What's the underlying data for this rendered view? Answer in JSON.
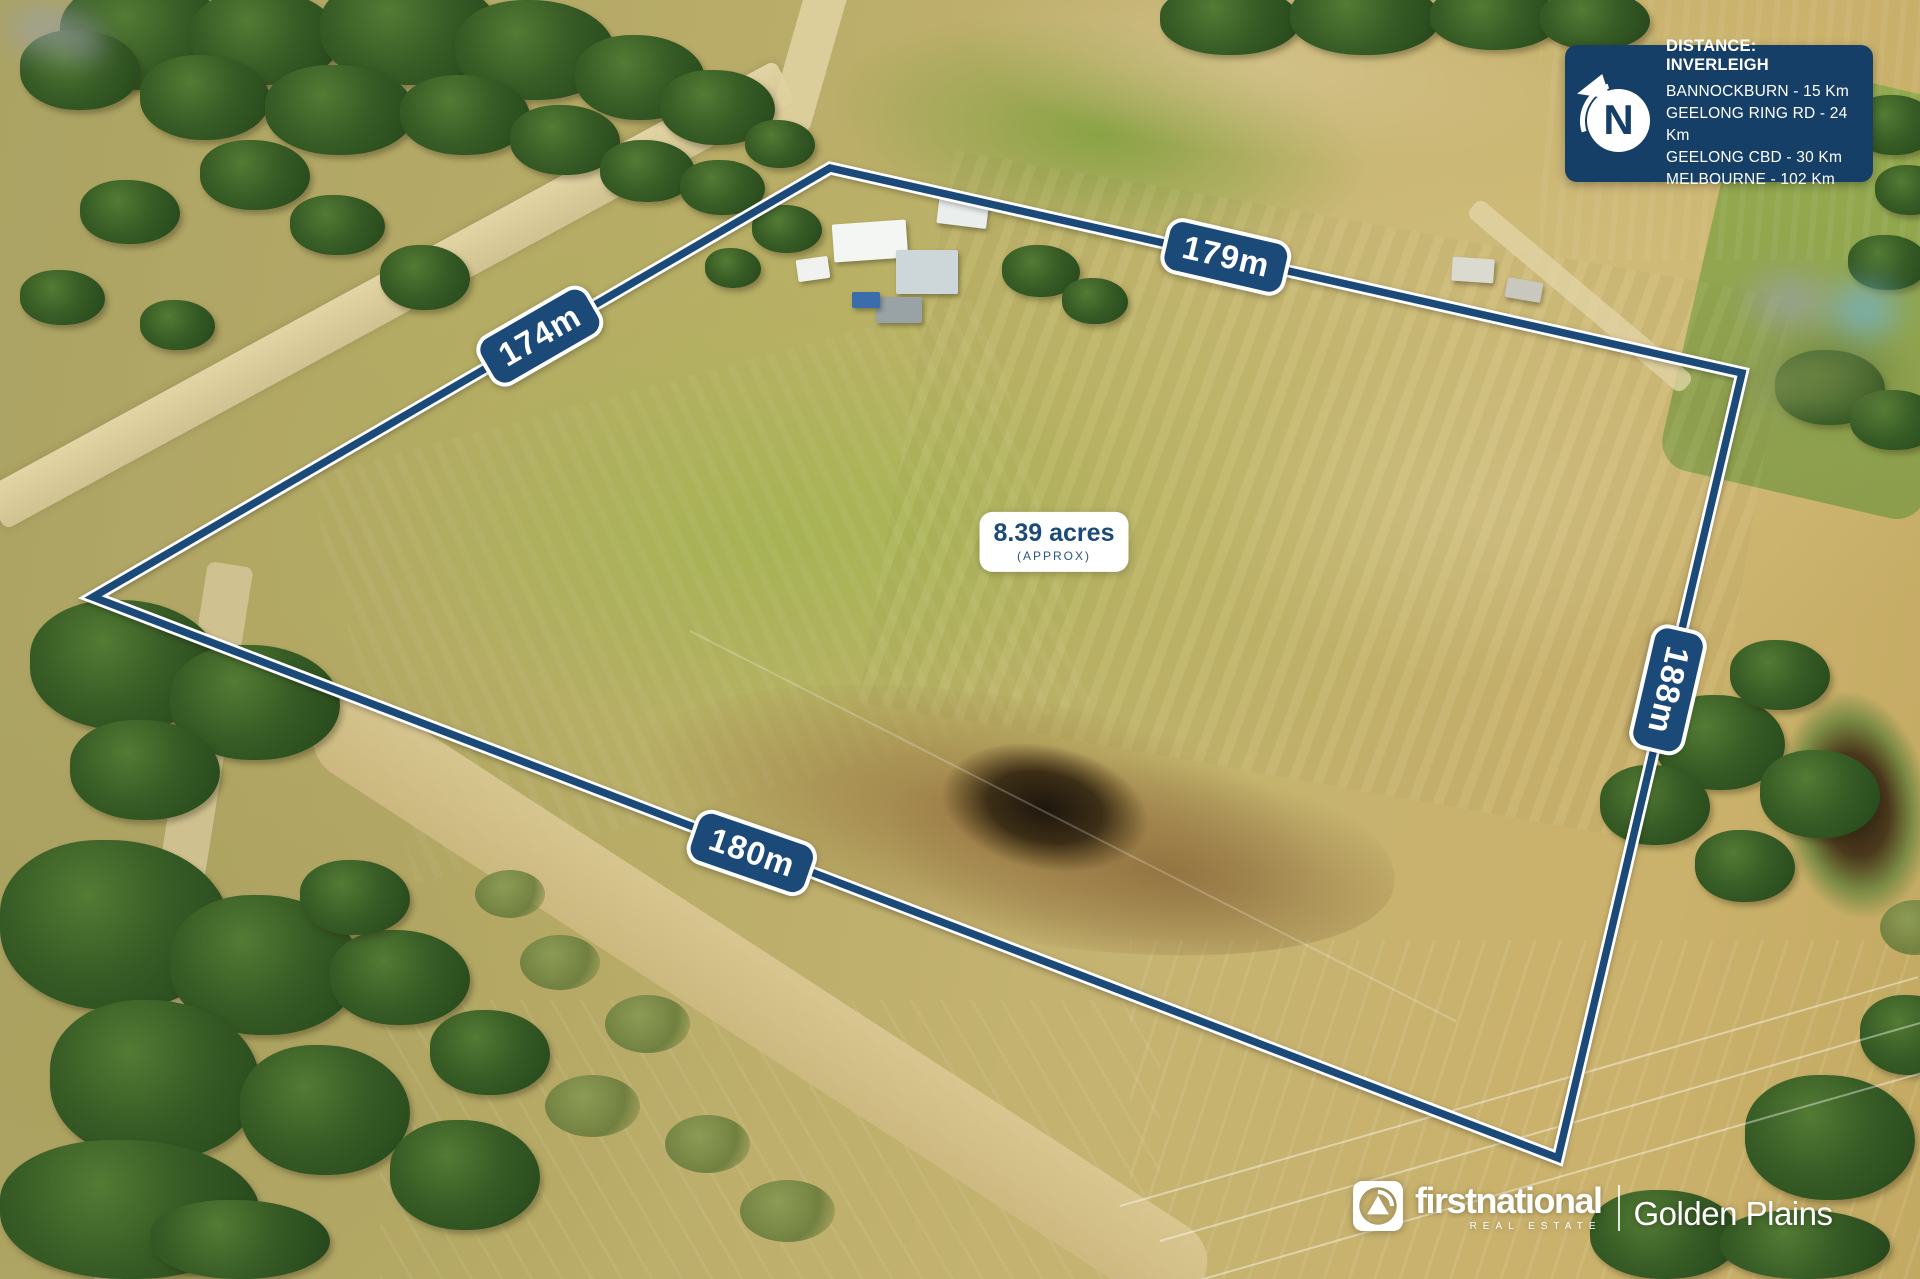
{
  "distance_panel": {
    "title": "DISTANCE: INVERLEIGH",
    "items": [
      "BANNOCKBURN - 15 Km",
      "GEELONG RING RD - 24 Km",
      "GEELONG CBD - 30 Km",
      "MELBOURNE - 102 Km"
    ],
    "compass_letter": "N"
  },
  "area_label": {
    "value": "8.39 acres",
    "qualifier": "(APPROX)"
  },
  "measurements": {
    "top_left": "174m",
    "top_right": "179m",
    "right": "188m",
    "bottom": "180m"
  },
  "branding": {
    "name": "firstnational",
    "tagline": "REAL ESTATE",
    "office": "Golden Plains"
  },
  "colors": {
    "boundary_navy": "#1c4a78",
    "panel_navy": "#163f68",
    "label_white": "#ffffff"
  }
}
